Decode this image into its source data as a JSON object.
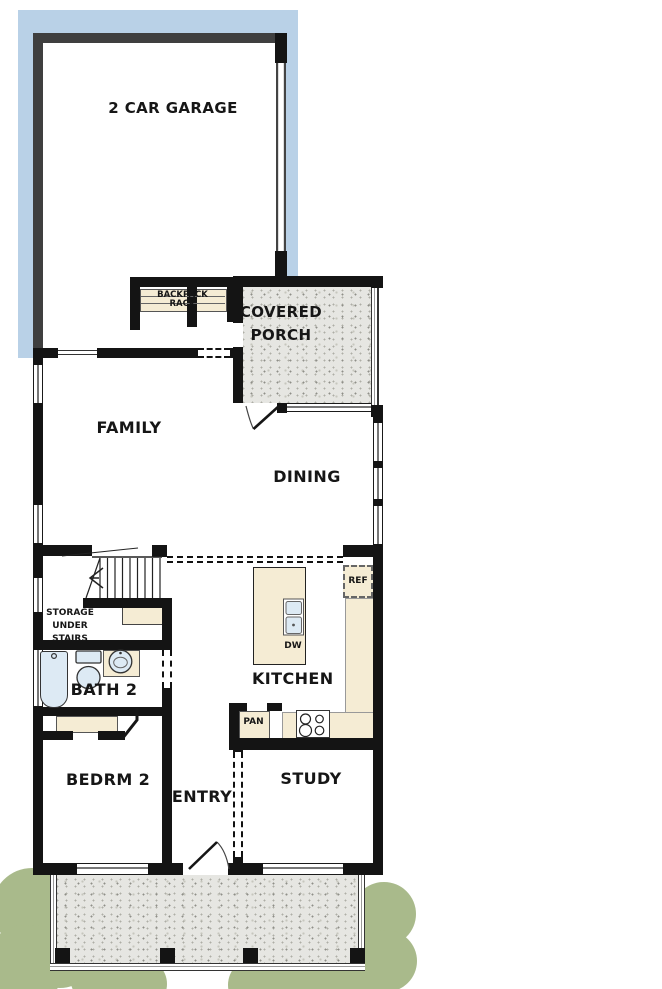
{
  "plan": {
    "rooms": {
      "garage": "2 CAR GARAGE",
      "covered_porch_line1": "COVERED",
      "covered_porch_line2": "PORCH",
      "family": "FAMILY",
      "dining": "DINING",
      "kitchen": "KITCHEN",
      "bath2": "BATH 2",
      "bedrm2": "BEDRM 2",
      "entry": "ENTRY",
      "study": "STUDY"
    },
    "fixtures": {
      "backpack_line1": "BACKPACK",
      "backpack_line2": "RACK",
      "storage_line1": "STORAGE",
      "storage_line2": "UNDER",
      "storage_line3": "STAIRS",
      "ref": "REF",
      "dw": "DW",
      "pan": "PAN"
    },
    "colors": {
      "driveway_blue": "#b9d1e7",
      "porch_concrete": "#e6e6e2",
      "counter_beige": "#f5ecd4",
      "fixture_blue": "#ddeaf4",
      "bush_green": "#a9ba8b",
      "wall_black": "#141414",
      "garage_wall_gray": "#3f3f3f"
    }
  }
}
